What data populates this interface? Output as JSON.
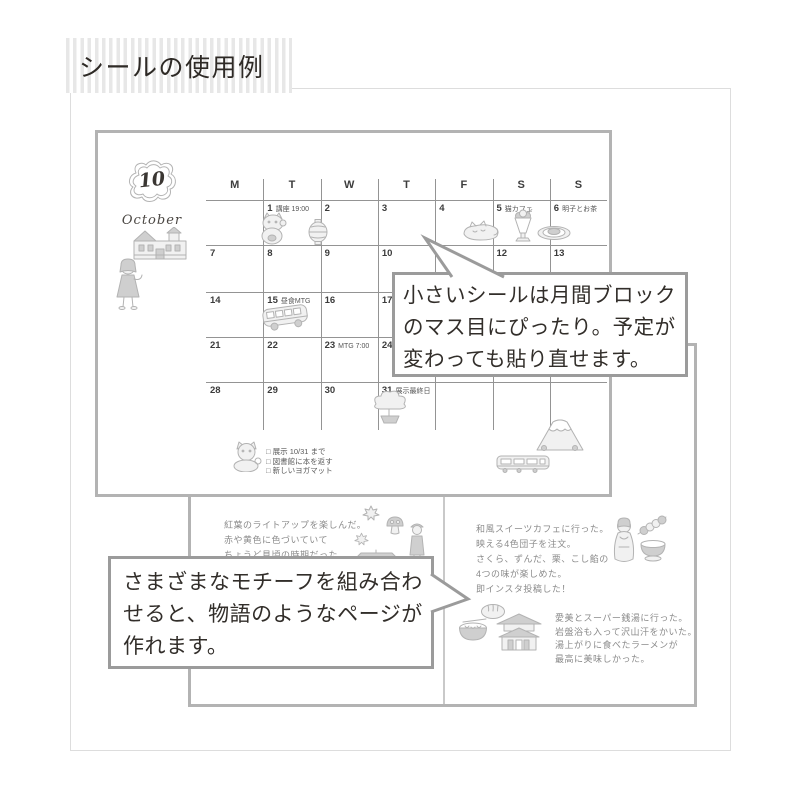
{
  "title": "シールの使用例",
  "speech_bubbles": {
    "monthly": {
      "lines": [
        "小さいシールは月間ブロック",
        "のマス目にぴったり。予定が",
        "変わっても貼り直せます。"
      ]
    },
    "motif": {
      "lines": [
        "さまざまなモチーフを組み合わ",
        "せると、物語のようなページが",
        "作れます。"
      ]
    }
  },
  "calendar": {
    "month_number": "10",
    "month_name": "October",
    "weekdays": [
      "M",
      "T",
      "W",
      "T",
      "F",
      "S",
      "S"
    ],
    "weeks": [
      [
        {
          "d": ""
        },
        {
          "d": "1",
          "note": "講座 19:00"
        },
        {
          "d": "2"
        },
        {
          "d": "3"
        },
        {
          "d": "4"
        },
        {
          "d": "5",
          "note": "猫カフェ"
        },
        {
          "d": "6",
          "note": "明子とお茶"
        }
      ],
      [
        {
          "d": "7"
        },
        {
          "d": "8"
        },
        {
          "d": "9"
        },
        {
          "d": "10"
        },
        {
          "d": "11"
        },
        {
          "d": "12"
        },
        {
          "d": "13"
        }
      ],
      [
        {
          "d": "14"
        },
        {
          "d": "15",
          "note": "昼食MTG"
        },
        {
          "d": "16"
        },
        {
          "d": "17"
        },
        {
          "d": "18"
        },
        {
          "d": "19"
        },
        {
          "d": "20"
        }
      ],
      [
        {
          "d": "21"
        },
        {
          "d": "22"
        },
        {
          "d": "23",
          "note": "MTG 7:00"
        },
        {
          "d": "24"
        },
        {
          "d": "25"
        },
        {
          "d": "26"
        },
        {
          "d": "27"
        }
      ],
      [
        {
          "d": "28"
        },
        {
          "d": "29"
        },
        {
          "d": "30"
        },
        {
          "d": "31",
          "note": "展示最終日"
        },
        {
          "d": ""
        },
        {
          "d": ""
        },
        {
          "d": ""
        }
      ]
    ],
    "checklist": [
      "展示 10/31 まで",
      "図書館に本を返す",
      "新しいヨガマット"
    ]
  },
  "journal": {
    "left_entry_lines": [
      "紅葉のライトアップを楽しんだ。",
      "赤や黄色に色づいていて",
      "ちょうど見頃の時期だった。"
    ],
    "right_entry1_lines": [
      "和風スイーツカフェに行った。",
      "映える4色団子を注文。",
      "さくら、ずんだ、栗、こし餡の",
      "4つの味が楽しめた。",
      "即インスタ投稿した！"
    ],
    "right_entry2_lines": [
      "愛美とスーパー銭湯に行った。",
      "岩盤浴も入って沢山汗をかいた。",
      "湯上がりに食べたラーメンが",
      "最高に美味しかった。"
    ]
  },
  "stickers": {
    "calendar_page": [
      "month-cloud-frame",
      "western-mansion",
      "walking-girl",
      "maneki-neko",
      "paper-lantern",
      "curled-cat",
      "parfait",
      "dessert-plate",
      "bus",
      "bonsai-tree",
      "shiba-dog",
      "mt-fuji",
      "train"
    ],
    "journal_left_page": [
      "maple-leaf",
      "mushroom",
      "maple-leaf",
      "strolling-person",
      "temple-roof"
    ],
    "journal_right_page": [
      "kimono-person",
      "dango-skewer",
      "matcha-bowl",
      "onsen-manju",
      "ramen-bowl",
      "bathhouse"
    ]
  },
  "colors": {
    "page_border": "#b3b3b3",
    "bubble_border": "#9b9b9b",
    "grid_line": "#949494",
    "text_dark": "#322e2a",
    "journal_ink": "#8b8b8b",
    "stripe_gray": "#e7e7e7",
    "frame_gray": "#dddddd",
    "sticker_gray": "#b3b3b3"
  }
}
